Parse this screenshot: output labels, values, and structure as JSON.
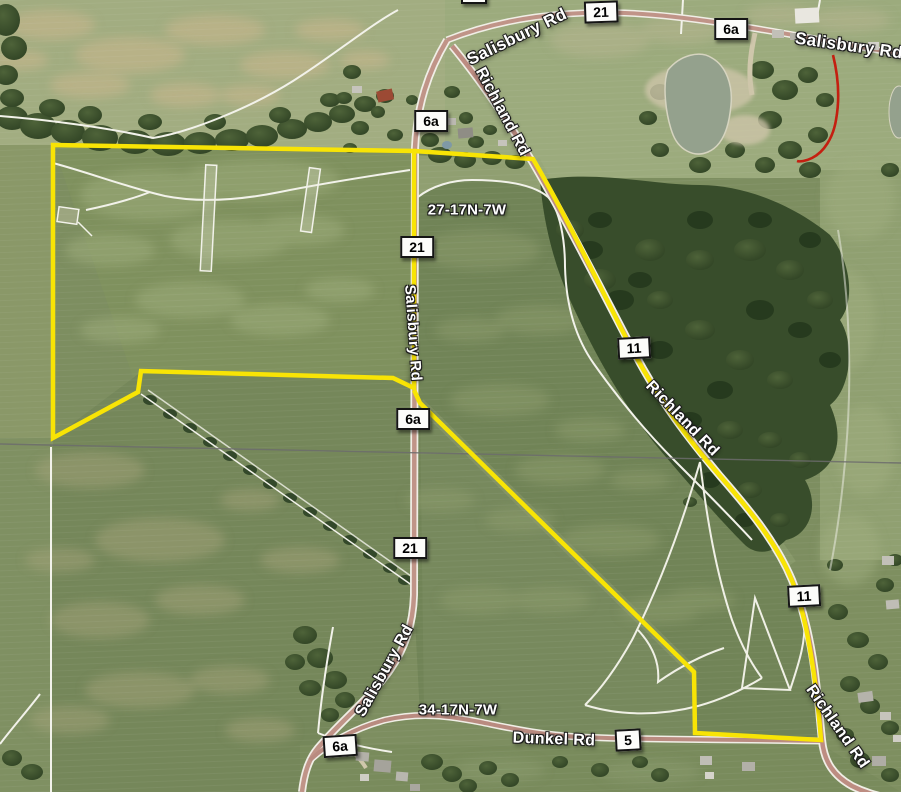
{
  "map": {
    "type": "aerial-parcel-map",
    "road_names": [
      "Salisbury Rd",
      "Richland Rd",
      "Dunkel Rd"
    ],
    "route_numbers": [
      "21",
      "6a",
      "11",
      "5"
    ],
    "route_markers": [
      {
        "label": "21"
      },
      {
        "label": "6a"
      },
      {
        "label": "6a"
      },
      {
        "label": "21"
      },
      {
        "label": "6a"
      },
      {
        "label": "11"
      },
      {
        "label": "21"
      },
      {
        "label": "11"
      },
      {
        "label": "6a"
      },
      {
        "label": "5"
      }
    ],
    "road_labels": [
      {
        "text": "Salisbury Rd"
      },
      {
        "text": "Salisbury Rd"
      },
      {
        "text": "Richland Rd"
      },
      {
        "text": "Salisbury Rd"
      },
      {
        "text": "Richland Rd"
      },
      {
        "text": "Salisbury Rd"
      },
      {
        "text": "Dunkel Rd"
      },
      {
        "text": "Richland Rd"
      }
    ],
    "section_labels": [
      {
        "text": "27-17N-7W"
      },
      {
        "text": "34-17N-7W"
      }
    ],
    "colors": {
      "parcel_boundary_yellow": "#f8e405",
      "highlight_route_red": "#c41f10",
      "powerline_gray": "#6c6c6c",
      "road_surface": "#c09488",
      "field_green": "#7d8e60"
    }
  }
}
